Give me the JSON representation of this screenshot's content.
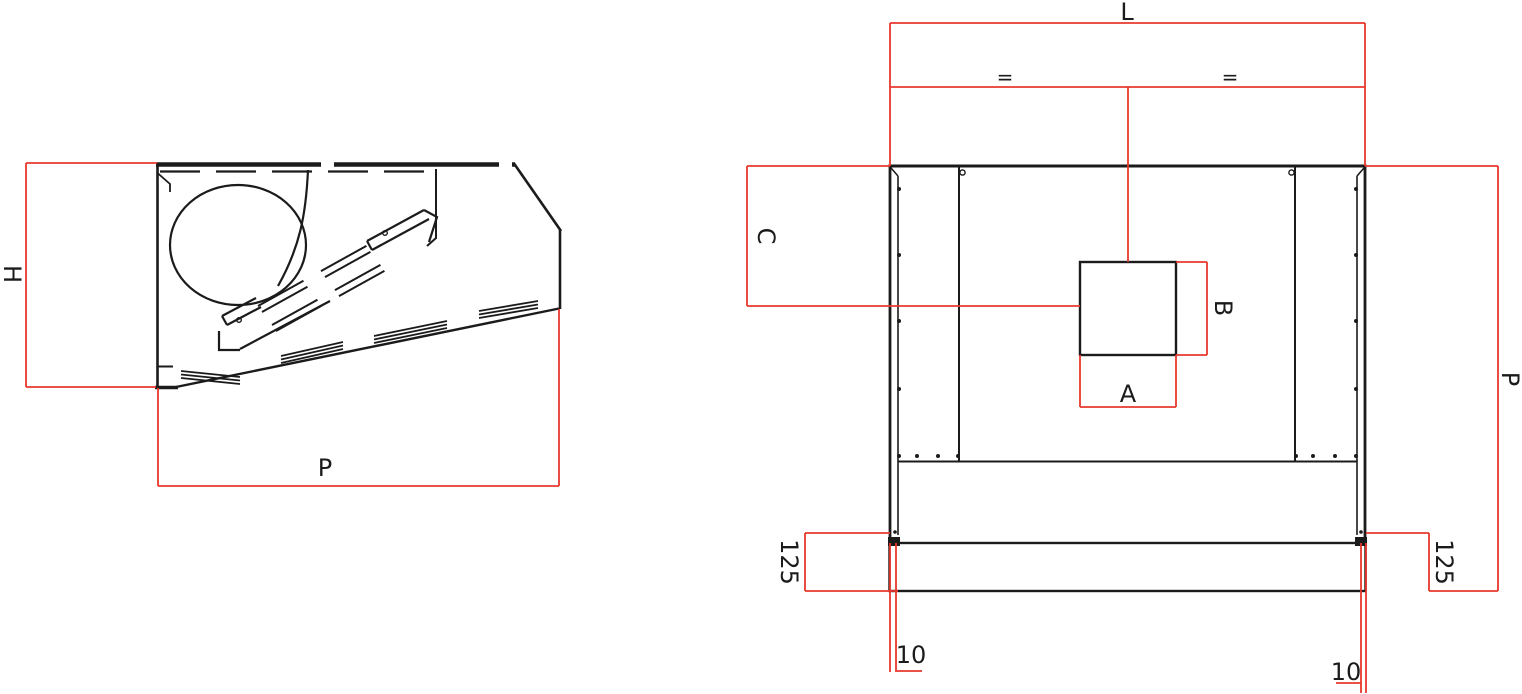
{
  "colors": {
    "background": "#ffffff",
    "line": "#1b1b1b",
    "dimension": "#e8382c"
  },
  "side_view": {
    "label_height": "H",
    "label_depth": "P"
  },
  "plan_view": {
    "label_length": "L",
    "label_equal_left": "=",
    "label_equal_right": "=",
    "label_side_offset": "C",
    "label_duct_width": "A",
    "label_duct_depth": "B",
    "label_depth": "P",
    "label_flange_left": "125",
    "label_flange_right": "125",
    "label_edge_left": "10",
    "label_edge_right": "10"
  }
}
